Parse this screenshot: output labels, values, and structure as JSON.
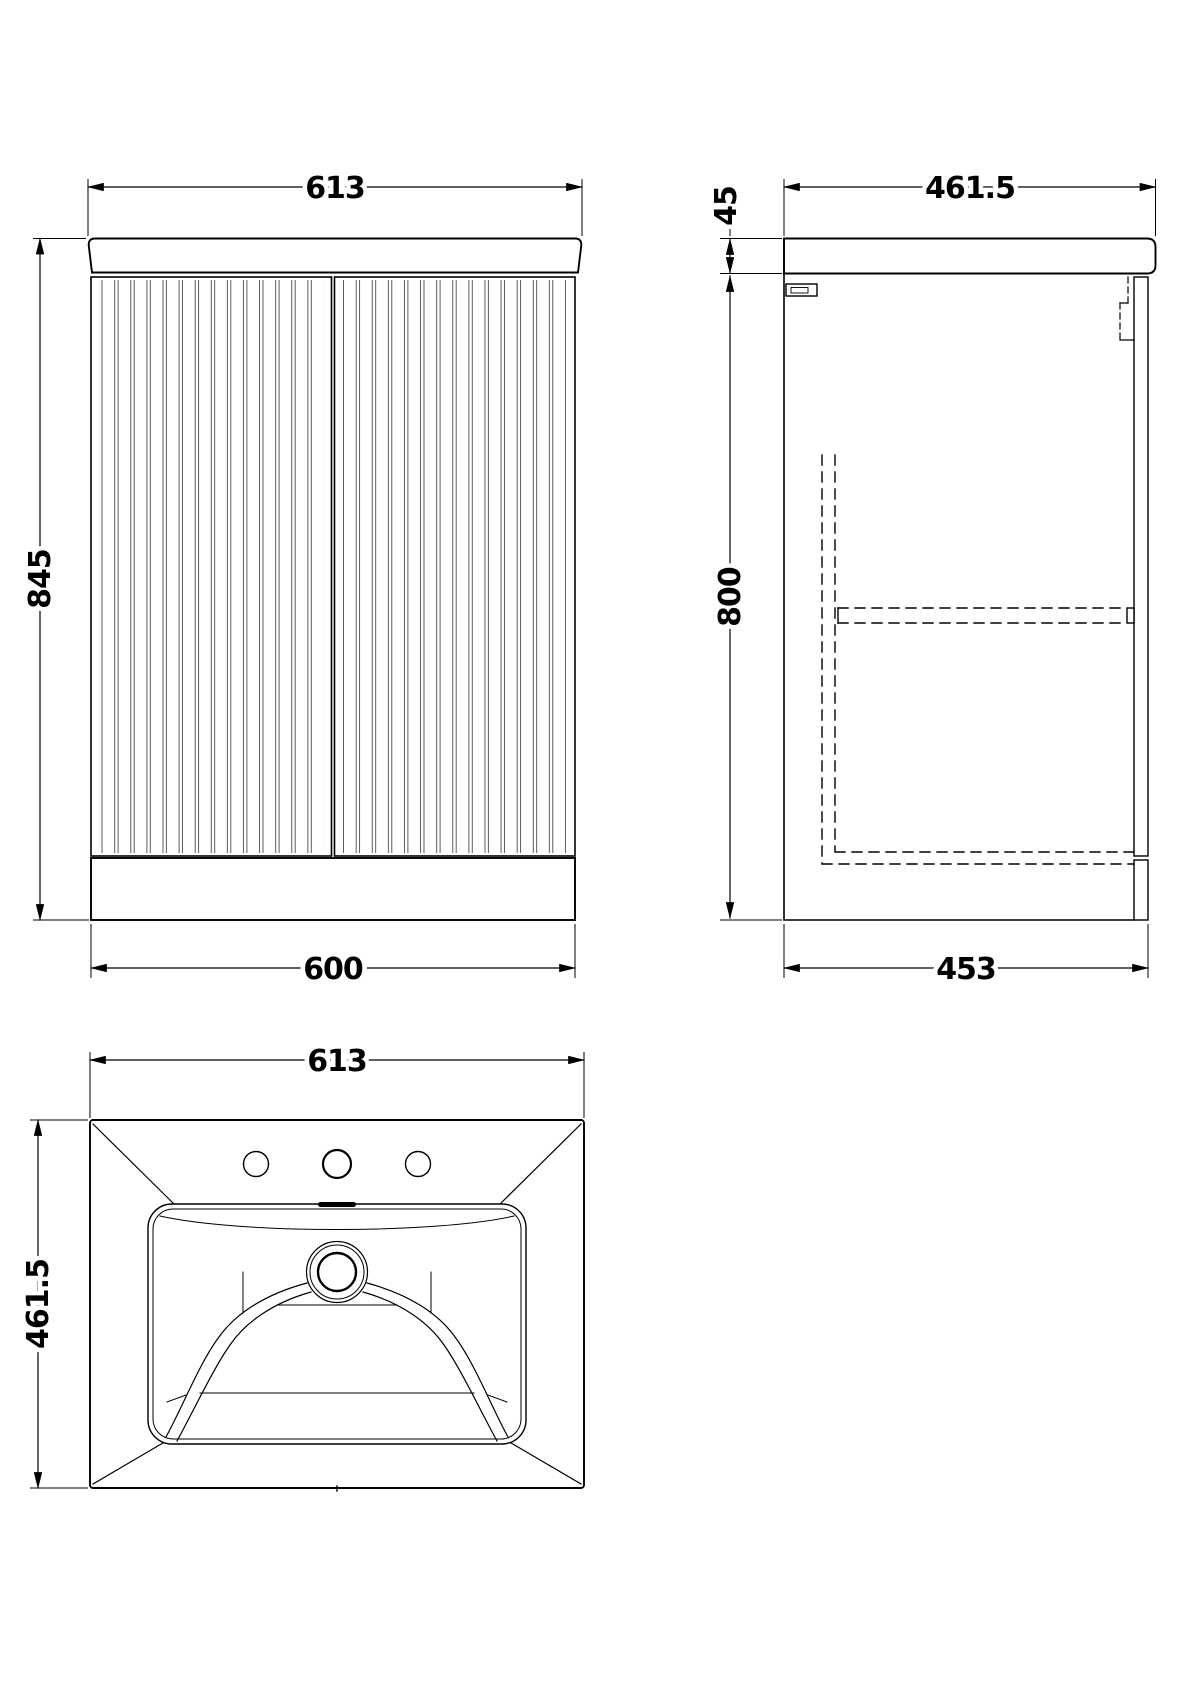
{
  "drawing": {
    "background_color": "#ffffff",
    "line_color": "#000000",
    "views": {
      "front": {
        "width_top_mm": "613",
        "height_mm": "845",
        "width_bottom_mm": "600"
      },
      "side": {
        "depth_top_mm": "461.5",
        "worktop_thickness_mm": "45",
        "cabinet_height_mm": "800",
        "depth_bottom_mm": "453"
      },
      "basin": {
        "width_mm": "613",
        "depth_mm": "461.5"
      }
    }
  }
}
